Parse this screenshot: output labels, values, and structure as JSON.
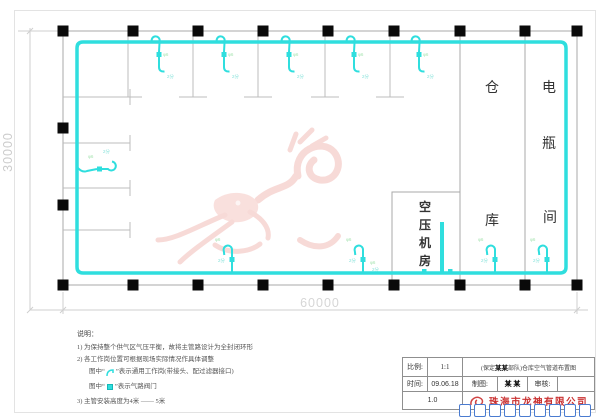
{
  "drawing": {
    "dimensions": {
      "width": "60000",
      "height": "30000"
    },
    "rooms": {
      "warehouse": {
        "chars": [
          "仓",
          "库"
        ]
      },
      "battery": {
        "chars": [
          "电",
          "瓶",
          "间"
        ]
      },
      "compressor": {
        "chars": [
          "空",
          "压",
          "机",
          "房"
        ]
      }
    },
    "pipe_labels": {
      "size": "φ6",
      "tap": "2分"
    }
  },
  "notes": {
    "heading": "说明：",
    "item1": "1) 为保持整个供气区气压平衡，故将主管路设计为全封闭环形",
    "item2": "2) 各工作岗位置可根据现场实际情况作具体调整",
    "item3_pre": "图中“",
    "item3_post": "”表示通用工作岗(带接头、配过滤器接口)",
    "item4_pre": "图中“",
    "item4_post": "”表示气路阀门",
    "item5": "3) 主管安装高度为4米 —— 5米"
  },
  "title_block": {
    "scale_label": "比例:",
    "scale_value": "1:1",
    "project_pre": "(保定 ",
    "project_bold": "某某",
    "project_post": " 部队)仓库空气管道布置图",
    "date_label": "时间:",
    "date_value": "09.06.18",
    "drafter_label": "制图:",
    "drafter_value": "某 某",
    "reviewer_label": "审核:",
    "reviewer_value": "",
    "version": "1.0",
    "company": "珠海市龙神有限公司"
  }
}
